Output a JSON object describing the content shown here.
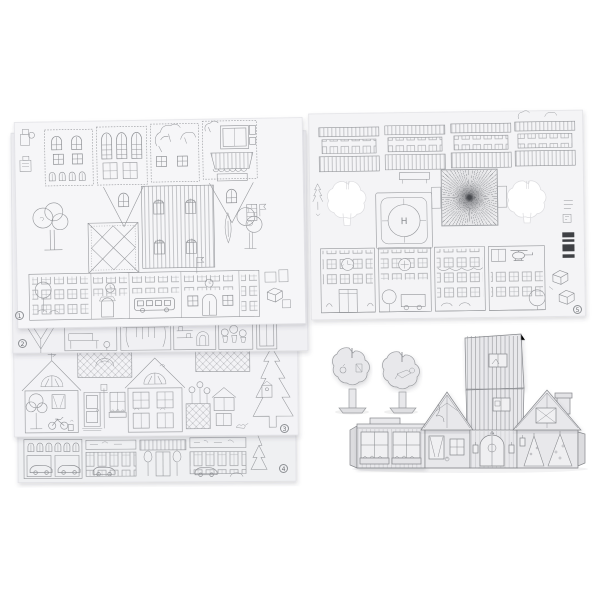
{
  "colors": {
    "background": "#ffffff",
    "sheet_fill": "#f4f4f6",
    "sheet_line": "#97999d",
    "model_fill": "#e8e8eb",
    "model_line": "#797b80",
    "cutout_fill": "#ffffff",
    "barcode_ink": "#3f4145",
    "badge_ink": "#6b6e73"
  },
  "sheets": [
    {
      "number": "1"
    },
    {
      "number": "2"
    },
    {
      "number": "3"
    },
    {
      "number": "4"
    },
    {
      "number": "5"
    }
  ],
  "sheet5": {
    "helipad_letter": "H"
  }
}
